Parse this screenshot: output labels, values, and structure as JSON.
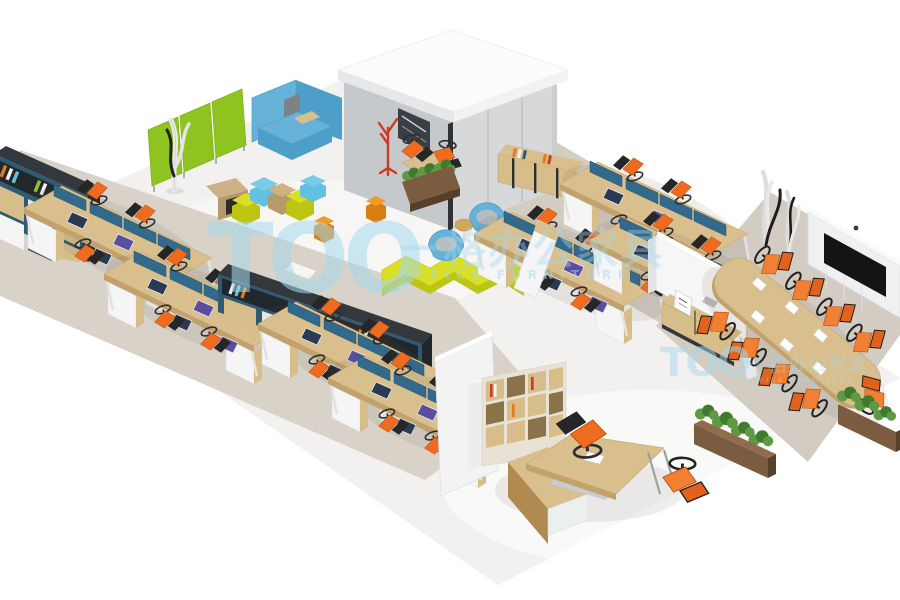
{
  "watermark": {
    "primary": {
      "logo": "TOO",
      "cn": "一格办公家具",
      "en": "OFFICE FURNITURE"
    },
    "secondary": {
      "logo": "TOO",
      "cn": "一格办公家具",
      "en": "OFFICE FURNITURE"
    }
  },
  "palette": {
    "floor": "#f2f1ef",
    "carpet": "#d9d2c8",
    "carpet2": "#d3ccc3",
    "wood": "#d9bf8e",
    "woodEdge": "#c2a26c",
    "woodDark": "#b08a50",
    "screen": "#336a8c",
    "cabNavy": "#2e5a72",
    "cabTan": "#d7bd8a",
    "whitef": "#f5f5f6",
    "cabFrame": "#33383e",
    "cabFrameD": "#22262b",
    "green": "#8fc31f",
    "greenDark": "#74a912",
    "sofaBlue": "#67b2d8",
    "sofaBlueD": "#4d9fc9",
    "hexBlue": "#62c0e0",
    "hexTan": "#cdb285",
    "hexTanD": "#b59a6d",
    "yellow": "#d8df25",
    "yellowDark": "#bcc414",
    "stoolOrange": "#f09a28",
    "stoolOrangeD": "#d87f12",
    "plant": "#5d9a43",
    "plantDark": "#3f7a2e",
    "planterWood": "#7c5c40",
    "planterDark": "#573f29",
    "wallGray": "#c6c9cc",
    "wallLight": "#d6d8da",
    "roofWhite": "#fbfbfc",
    "tv": "#141414",
    "chrome": "#9aa0a5",
    "chairSeat": "#ef6c1e",
    "chairBack": "#262626",
    "confSeat": "#f28033",
    "confBack": "#e2611b",
    "redStand": "#cf3b22",
    "watermark": "#a6d9ec"
  }
}
